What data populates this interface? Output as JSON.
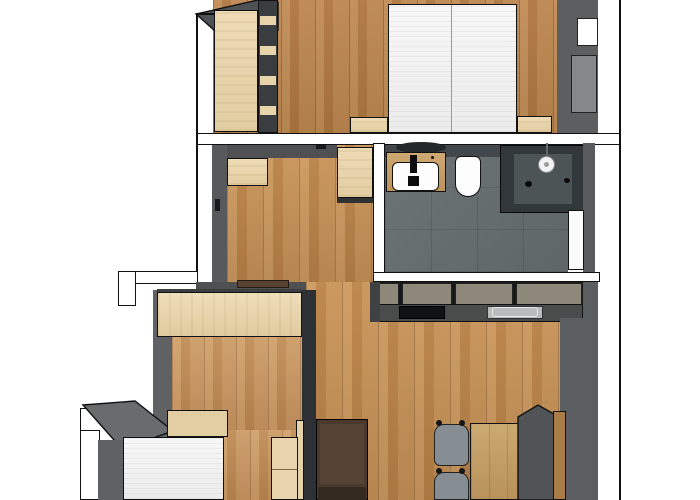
{
  "title": "apartment-floor-plan",
  "canvas": {
    "width": 700,
    "height": 500,
    "background": "#ffffff"
  },
  "palette": {
    "wall_cut_white": "#ffffff",
    "wall_face_gray": "#5a5c5e",
    "wall_dark": "#2e3133",
    "outline_black": "#111111",
    "wood_floor": "#b98551",
    "furniture_beige": "#e9d7b0",
    "bathroom_tile": "#687072",
    "shower_glass": "#31373a",
    "kitchen_front_olive": "#8d8879",
    "counter_gray": "#4a4c4c",
    "sofa_brown": "#4a3a2e",
    "bench_gray": "#515456",
    "chair_gray": "#878e93",
    "bed_white": "#f4f4f4"
  },
  "rooms": [
    {
      "name": "bedroom-1",
      "area": "top",
      "features": [
        "double-bed",
        "wardrobe",
        "shelf-column",
        "two-nightstands",
        "window-niche",
        "radiator"
      ]
    },
    {
      "name": "hallway",
      "area": "middle-left",
      "features": [
        "entry-door",
        "two-cabinets",
        "door-to-bedroom-1"
      ]
    },
    {
      "name": "bathroom",
      "area": "middle-right",
      "features": [
        "vanity-sink",
        "toilet",
        "walk-in-shower",
        "door"
      ]
    },
    {
      "name": "kitchen",
      "area": "center-right",
      "features": [
        "cabinet-run",
        "cooktop",
        "sink"
      ]
    },
    {
      "name": "living-dining",
      "area": "bottom-right",
      "features": [
        "sofa",
        "dining-table",
        "two-chairs",
        "bench"
      ]
    },
    {
      "name": "bedroom-2",
      "area": "bottom-left",
      "features": [
        "single-bed",
        "headboard",
        "wardrobe",
        "nightstand"
      ]
    }
  ],
  "elements": [
    {
      "name": "bedroom1-floor",
      "type": "rect",
      "x": 213,
      "y": 0,
      "w": 347,
      "h": 133,
      "cls": "wood-a"
    },
    {
      "name": "hallway-floor",
      "type": "rect",
      "x": 227,
      "y": 145,
      "w": 146,
      "h": 137,
      "cls": "wood-b"
    },
    {
      "name": "living-room-floor",
      "type": "rect",
      "x": 306,
      "y": 282,
      "w": 254,
      "h": 218,
      "cls": "wood-b"
    },
    {
      "name": "bedroom2-floor-upper",
      "type": "rect",
      "x": 172,
      "y": 337,
      "w": 132,
      "h": 93,
      "cls": "wood-c"
    },
    {
      "name": "bedroom2-floor-lower",
      "type": "rect",
      "x": 122,
      "y": 430,
      "w": 182,
      "h": 70,
      "cls": "wood-c"
    },
    {
      "name": "bathroom-floor",
      "type": "rect",
      "x": 385,
      "y": 145,
      "w": 183,
      "h": 127,
      "cls": "tile"
    },
    {
      "name": "bedroom1-wall-corner-wedge",
      "type": "poly",
      "x": 196,
      "y": 0,
      "w": 82,
      "h": 30,
      "points": "0,14 62,0 82,2 82,30 18,30",
      "fill": "#4f5254",
      "stroke": "#111"
    },
    {
      "name": "bedroom1-wardrobe",
      "type": "rect",
      "x": 214,
      "y": 10,
      "w": 44,
      "h": 122,
      "cls": "beige bordered"
    },
    {
      "name": "bedroom1-shelf-column",
      "type": "rect",
      "x": 258,
      "y": 0,
      "w": 20,
      "h": 133,
      "fill": "#3a3d40",
      "border": "#111"
    },
    {
      "name": "shelf-slat-1",
      "type": "rect",
      "x": 260,
      "y": 16,
      "w": 16,
      "h": 9,
      "fill": "#e7d4ab"
    },
    {
      "name": "shelf-slat-2",
      "type": "rect",
      "x": 260,
      "y": 46,
      "w": 16,
      "h": 9,
      "fill": "#e7d4ab"
    },
    {
      "name": "shelf-slat-3",
      "type": "rect",
      "x": 260,
      "y": 76,
      "w": 16,
      "h": 9,
      "fill": "#e7d4ab"
    },
    {
      "name": "shelf-slat-4",
      "type": "rect",
      "x": 260,
      "y": 106,
      "w": 16,
      "h": 9,
      "fill": "#e7d4ab"
    },
    {
      "name": "double-bed",
      "type": "rect",
      "x": 388,
      "y": 4,
      "w": 129,
      "h": 129,
      "cls": "bedding bordered"
    },
    {
      "name": "double-bed-center-seam",
      "type": "rect",
      "x": 451,
      "y": 5,
      "w": 1,
      "h": 127,
      "fill": "#9a9a9a"
    },
    {
      "name": "bedroom1-nightstand-left",
      "type": "rect",
      "x": 350,
      "y": 117,
      "w": 38,
      "h": 16,
      "cls": "beige bordered"
    },
    {
      "name": "bedroom1-nightstand-right",
      "type": "rect",
      "x": 517,
      "y": 116,
      "w": 35,
      "h": 17,
      "cls": "beige bordered"
    },
    {
      "name": "bedroom1-east-wall",
      "type": "rect",
      "x": 557,
      "y": 0,
      "w": 41,
      "h": 133,
      "fill": "#5c5e60"
    },
    {
      "name": "window-niche",
      "type": "rect",
      "x": 577,
      "y": 18,
      "w": 21,
      "h": 28,
      "fill": "#ffffff",
      "border": "#222"
    },
    {
      "name": "radiator",
      "type": "rect",
      "x": 571,
      "y": 55,
      "w": 26,
      "h": 58,
      "fill": "#84888b",
      "border": "#222",
      "cls": "radiator"
    },
    {
      "name": "wall-bedroom1-separator",
      "type": "rect",
      "x": 196,
      "y": 133,
      "w": 424,
      "h": 12,
      "fill": "#ffffff",
      "border": "#111"
    },
    {
      "name": "hallway-west-wall",
      "type": "rect",
      "x": 212,
      "y": 145,
      "w": 15,
      "h": 145,
      "fill": "#57595b"
    },
    {
      "name": "hallway-north-wall",
      "type": "rect",
      "x": 227,
      "y": 145,
      "w": 110,
      "h": 13,
      "fill": "#4e5052"
    },
    {
      "name": "hallway-cabinet-left",
      "type": "rect",
      "x": 227,
      "y": 158,
      "w": 41,
      "h": 28,
      "cls": "beige bordered"
    },
    {
      "name": "hallway-cabinet-right",
      "type": "rect",
      "x": 337,
      "y": 147,
      "w": 36,
      "h": 51,
      "cls": "beige bordered"
    },
    {
      "name": "hallway-cabinet-right-plinth",
      "type": "rect",
      "x": 337,
      "y": 198,
      "w": 36,
      "h": 5,
      "fill": "#2f3133"
    },
    {
      "name": "bedroom1-door-handle",
      "type": "rect",
      "x": 316,
      "y": 145,
      "w": 10,
      "h": 4,
      "fill": "#1a1a1a"
    },
    {
      "name": "entry-door-handle",
      "type": "rect",
      "x": 215,
      "y": 199,
      "w": 5,
      "h": 12,
      "fill": "#1a1a1a"
    },
    {
      "name": "exterior-wall-step-horizontal",
      "type": "rect",
      "x": 118,
      "y": 271,
      "w": 80,
      "h": 13,
      "fill": "#ffffff",
      "border": "#111"
    },
    {
      "name": "exterior-wall-step-vertical",
      "type": "rect",
      "x": 118,
      "y": 271,
      "w": 18,
      "h": 35,
      "fill": "#ffffff",
      "border": "#111"
    },
    {
      "name": "bedroom2-north-wall-face",
      "type": "rect",
      "x": 196,
      "y": 282,
      "w": 110,
      "h": 9,
      "fill": "#4e5052"
    },
    {
      "name": "bedroom2-door-lintel",
      "type": "rect",
      "x": 237,
      "y": 280,
      "w": 52,
      "h": 8,
      "fill": "#5a4233",
      "border": "#221a14"
    },
    {
      "name": "bathroom-west-wall",
      "type": "rect",
      "x": 373,
      "y": 143,
      "w": 12,
      "h": 139,
      "fill": "#ffffff",
      "border": "#111"
    },
    {
      "name": "bathroom-north-wall-face",
      "type": "rect",
      "x": 385,
      "y": 145,
      "w": 117,
      "h": 12,
      "fill": "#41474a"
    },
    {
      "name": "vanity-mirror-edge",
      "type": "ellipse",
      "x": 396,
      "y": 142,
      "w": 50,
      "h": 11,
      "fill": "#23282b"
    },
    {
      "name": "vanity-counter",
      "type": "rect",
      "x": 386,
      "y": 152,
      "w": 60,
      "h": 40,
      "cls": "wood-e bordered"
    },
    {
      "name": "vanity-sink",
      "type": "rect",
      "x": 392,
      "y": 162,
      "w": 47,
      "h": 29,
      "fill": "#fdfdfd",
      "border": "#111",
      "radius": "6px"
    },
    {
      "name": "faucet",
      "type": "rect",
      "x": 410,
      "y": 155,
      "w": 7,
      "h": 18,
      "fill": "#0d0d0d"
    },
    {
      "name": "faucet-base",
      "type": "rect",
      "x": 408,
      "y": 176,
      "w": 11,
      "h": 10,
      "fill": "#0d0d0d"
    },
    {
      "name": "vanity-drain-dot",
      "type": "ellipse",
      "x": 431,
      "y": 156,
      "w": 3,
      "h": 3,
      "fill": "#111"
    },
    {
      "name": "toilet",
      "type": "rect",
      "x": 455,
      "y": 156,
      "w": 26,
      "h": 41,
      "fill": "#fdfdfd",
      "border": "#111",
      "radius": "6px 6px 13px 13px"
    },
    {
      "name": "shower-enclosure",
      "type": "rect",
      "x": 500,
      "y": 145,
      "w": 85,
      "h": 68,
      "fill": "#31373a",
      "border": "#0a0a0a"
    },
    {
      "name": "shower-interior",
      "type": "rect",
      "x": 514,
      "y": 154,
      "w": 58,
      "h": 50,
      "fill": "#4d5456"
    },
    {
      "name": "shower-head-stem",
      "type": "rect",
      "x": 546,
      "y": 143,
      "w": 2,
      "h": 14,
      "fill": "#666666"
    },
    {
      "name": "shower-head",
      "type": "ellipse",
      "x": 538,
      "y": 156,
      "w": 17,
      "h": 17,
      "fill": "#f2f2f2",
      "border": "#888"
    },
    {
      "name": "shower-head-center",
      "type": "ellipse",
      "x": 544,
      "y": 162,
      "w": 5,
      "h": 5,
      "fill": "#9aa0a0"
    },
    {
      "name": "shower-control-knob",
      "type": "ellipse",
      "x": 525,
      "y": 181,
      "w": 7,
      "h": 6,
      "fill": "#0a0a0a"
    },
    {
      "name": "shower-door-handle",
      "type": "ellipse",
      "x": 564,
      "y": 178,
      "w": 6,
      "h": 5,
      "fill": "#0a0a0a"
    },
    {
      "name": "bathroom-east-wall",
      "type": "rect",
      "x": 583,
      "y": 143,
      "w": 12,
      "h": 139,
      "fill": "#595c5e"
    },
    {
      "name": "bathroom-door",
      "type": "rect",
      "x": 568,
      "y": 210,
      "w": 16,
      "h": 60,
      "fill": "#fbfbfb",
      "border": "#111"
    },
    {
      "name": "kitchen-back-wall",
      "type": "rect",
      "x": 373,
      "y": 272,
      "w": 227,
      "h": 10,
      "fill": "#ffffff",
      "border": "#111"
    },
    {
      "name": "kitchen-cabinet-gaps",
      "type": "rect",
      "x": 373,
      "y": 282,
      "w": 212,
      "h": 24,
      "fill": "#17181a"
    },
    {
      "name": "kitchen-cabinet-front-1",
      "type": "rect",
      "x": 375,
      "y": 283,
      "w": 24,
      "h": 22,
      "fill": "#8d8879",
      "border": "#222"
    },
    {
      "name": "kitchen-cabinet-front-2",
      "type": "rect",
      "x": 402,
      "y": 283,
      "w": 50,
      "h": 22,
      "fill": "#8d8879",
      "border": "#222"
    },
    {
      "name": "kitchen-cabinet-front-3",
      "type": "rect",
      "x": 455,
      "y": 283,
      "w": 58,
      "h": 22,
      "fill": "#8d8879",
      "border": "#222"
    },
    {
      "name": "kitchen-cabinet-front-4",
      "type": "rect",
      "x": 516,
      "y": 283,
      "w": 66,
      "h": 22,
      "fill": "#8d8879",
      "border": "#222"
    },
    {
      "name": "kitchen-counter",
      "type": "rect",
      "x": 373,
      "y": 304,
      "w": 210,
      "h": 18,
      "fill": "#4a4c4c",
      "border": "#111"
    },
    {
      "name": "cooktop",
      "type": "rect",
      "x": 399,
      "y": 306,
      "w": 46,
      "h": 13,
      "fill": "#101112",
      "border": "#000"
    },
    {
      "name": "kitchen-sink",
      "type": "rect",
      "x": 487,
      "y": 306,
      "w": 56,
      "h": 13,
      "fill": "#b9bcbc",
      "border": "#333"
    },
    {
      "name": "kitchen-sink-rim",
      "type": "rect",
      "x": 492,
      "y": 307,
      "w": 46,
      "h": 10,
      "fill": "none",
      "border": "#e8e8e8",
      "radius": "3px"
    },
    {
      "name": "kitchen-side-panel",
      "type": "rect",
      "x": 370,
      "y": 282,
      "w": 10,
      "h": 40,
      "fill": "#3f4143"
    },
    {
      "name": "east-wall-upper",
      "type": "rect",
      "x": 583,
      "y": 282,
      "w": 15,
      "h": 36,
      "fill": "#5b5e60"
    },
    {
      "name": "east-wall-lower",
      "type": "rect",
      "x": 560,
      "y": 318,
      "w": 38,
      "h": 182,
      "fill": "#5b5e60"
    },
    {
      "name": "bedroom2-east-wall",
      "type": "rect",
      "x": 302,
      "y": 290,
      "w": 14,
      "h": 210,
      "fill": "#2e3133"
    },
    {
      "name": "bedroom2-door-leaf",
      "type": "rect",
      "x": 296,
      "y": 420,
      "w": 8,
      "h": 80,
      "fill": "#e6d2a8",
      "border": "#111"
    },
    {
      "name": "sofa",
      "type": "rect",
      "x": 316,
      "y": 419,
      "w": 52,
      "h": 81,
      "fill": "#4a3a2e",
      "border": "#000"
    },
    {
      "name": "sofa-back-cushion",
      "type": "rect",
      "x": 320,
      "y": 424,
      "w": 44,
      "h": 60,
      "fill": "#554435"
    },
    {
      "name": "sofa-seat",
      "type": "rect",
      "x": 318,
      "y": 487,
      "w": 48,
      "h": 13,
      "fill": "#342a22"
    },
    {
      "name": "dining-chair-1",
      "type": "rect",
      "x": 434,
      "y": 424,
      "w": 35,
      "h": 42,
      "fill": "#878e93",
      "border": "#222",
      "radius": "10px 10px 6px 6px"
    },
    {
      "name": "chair-1-post-left",
      "type": "ellipse",
      "x": 436,
      "y": 420,
      "w": 6,
      "h": 6,
      "fill": "#151515"
    },
    {
      "name": "chair-1-post-right",
      "type": "ellipse",
      "x": 459,
      "y": 420,
      "w": 6,
      "h": 6,
      "fill": "#151515"
    },
    {
      "name": "dining-chair-2",
      "type": "rect",
      "x": 434,
      "y": 472,
      "w": 35,
      "h": 28,
      "fill": "#878e93",
      "border": "#222",
      "radius": "10px 10px 0 0"
    },
    {
      "name": "chair-2-post-left",
      "type": "ellipse",
      "x": 436,
      "y": 468,
      "w": 6,
      "h": 6,
      "fill": "#151515"
    },
    {
      "name": "chair-2-post-right",
      "type": "ellipse",
      "x": 459,
      "y": 468,
      "w": 6,
      "h": 6,
      "fill": "#151515"
    },
    {
      "name": "dining-table",
      "type": "rect",
      "x": 470,
      "y": 423,
      "w": 52,
      "h": 77,
      "cls": "wood-d bordered"
    },
    {
      "name": "bench-seat",
      "type": "poly",
      "x": 518,
      "y": 405,
      "w": 36,
      "h": 95,
      "points": "0,12 20,0 36,9 36,95 0,95",
      "fill": "#515456",
      "stroke": "#111"
    },
    {
      "name": "bench-backrest",
      "type": "rect",
      "x": 553,
      "y": 411,
      "w": 13,
      "h": 89,
      "fill": "#a97c49",
      "border": "#111"
    },
    {
      "name": "bedroom2-west-wall-face",
      "type": "rect",
      "x": 153,
      "y": 290,
      "w": 19,
      "h": 155,
      "fill": "#5f6163"
    },
    {
      "name": "bedroom2-wardrobe-top-edge",
      "type": "rect",
      "x": 157,
      "y": 289,
      "w": 145,
      "h": 5,
      "fill": "#3c3e40"
    },
    {
      "name": "bedroom2-wardrobe",
      "type": "rect",
      "x": 157,
      "y": 292,
      "w": 145,
      "h": 45,
      "cls": "beige-h bordered"
    },
    {
      "name": "southwest-wall-white",
      "type": "rect",
      "x": 80,
      "y": 408,
      "w": 46,
      "h": 38,
      "fill": "#ffffff",
      "border": "#111"
    },
    {
      "name": "southwest-wall-top-face",
      "type": "poly",
      "x": 80,
      "y": 400,
      "w": 95,
      "h": 50,
      "points": "3,5 55,1 93,31 42,49",
      "fill": "#696b6d",
      "stroke": "#111"
    },
    {
      "name": "bedroom2-lower-west-wall",
      "type": "rect",
      "x": 80,
      "y": 430,
      "w": 20,
      "h": 70,
      "fill": "#ffffff",
      "border": "#111"
    },
    {
      "name": "bedroom2-lower-west-face",
      "type": "rect",
      "x": 98,
      "y": 440,
      "w": 25,
      "h": 60,
      "fill": "#5f6163"
    },
    {
      "name": "single-bed-headboard",
      "type": "rect",
      "x": 167,
      "y": 410,
      "w": 61,
      "h": 27,
      "fill": "#e3cda2",
      "border": "#111"
    },
    {
      "name": "single-bed",
      "type": "rect",
      "x": 123,
      "y": 437,
      "w": 101,
      "h": 63,
      "cls": "bedding bordered"
    },
    {
      "name": "bedroom2-nightstand",
      "type": "rect",
      "x": 271,
      "y": 437,
      "w": 27,
      "h": 63,
      "fill": "#e8d5ad",
      "border": "#111"
    },
    {
      "name": "bedroom2-nightstand-seam",
      "type": "rect",
      "x": 272,
      "y": 469,
      "w": 25,
      "h": 1,
      "fill": "#7a6a4c"
    },
    {
      "name": "plan-boundary-left",
      "type": "rect",
      "x": 196,
      "y": 13,
      "w": 2,
      "h": 259,
      "fill": "#111"
    },
    {
      "name": "plan-boundary-top-left",
      "type": "rect",
      "x": 196,
      "y": 13,
      "w": 18,
      "h": 2,
      "fill": "#111"
    },
    {
      "name": "plan-boundary-right",
      "type": "rect",
      "x": 619,
      "y": 0,
      "w": 2,
      "h": 500,
      "fill": "#111"
    }
  ]
}
